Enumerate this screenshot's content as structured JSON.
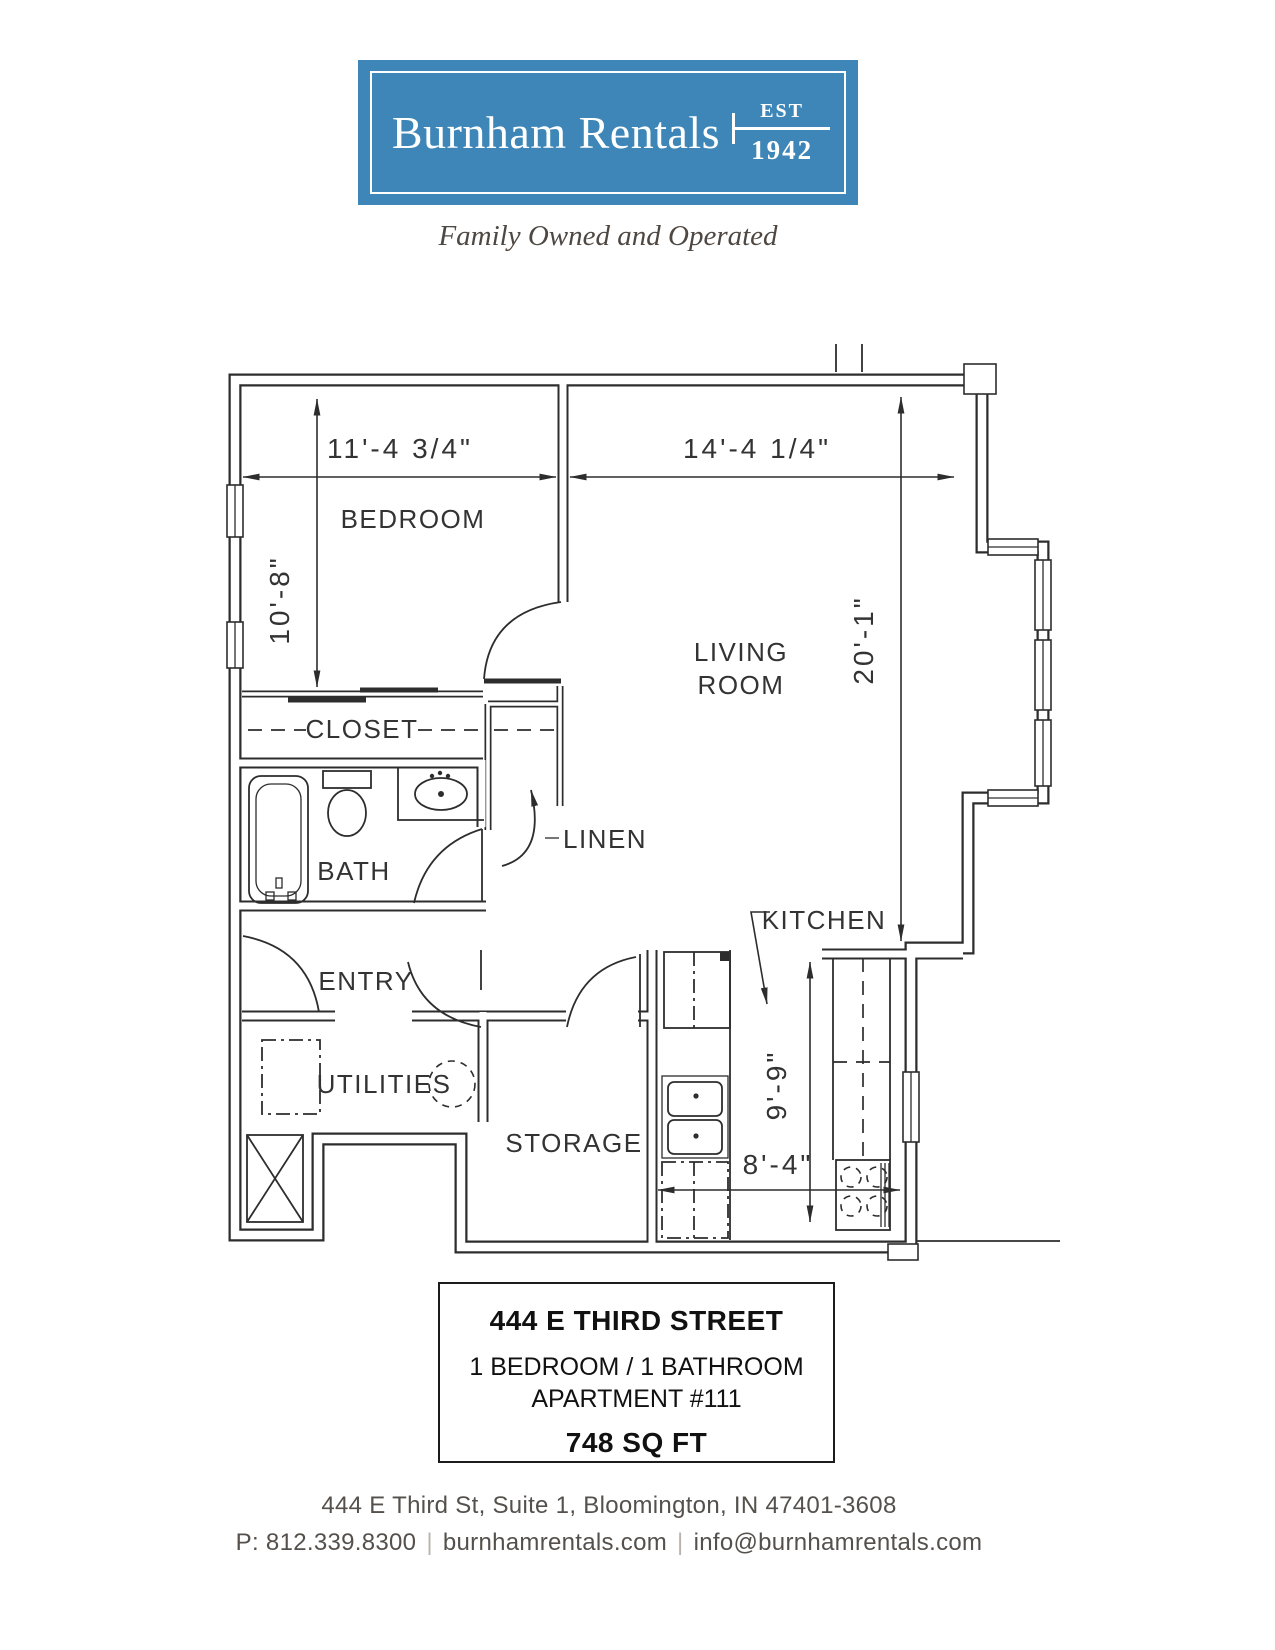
{
  "colors": {
    "accent_blue": "#3d86b7",
    "tagline_brown": "#4e4742",
    "footer_gray": "#55504c",
    "plan_line": "#2d2d2d"
  },
  "logo": {
    "brand": "Burnham Rentals",
    "est": "EST",
    "year": "1942"
  },
  "tagline": "Family Owned and Operated",
  "plan": {
    "rooms": {
      "bedroom": "BEDROOM",
      "closet": "CLOSET",
      "bath": "BATH",
      "linen": "LINEN",
      "entry": "ENTRY",
      "utilities": "UTILITIES",
      "storage": "STORAGE",
      "kitchen": "KITCHEN",
      "living1": "LIVING",
      "living2": "ROOM"
    },
    "dims": {
      "bedroom_w": "11'-4 3/4\"",
      "living_w": "14'-4 1/4\"",
      "bedroom_d": "10'-8\"",
      "living_d": "20'-1\"",
      "kitchen_d": "9'-9\"",
      "kitchen_w": "8'-4\""
    }
  },
  "info": {
    "street": "444 E THIRD STREET",
    "beds": "1 BEDROOM / 1 BATHROOM",
    "apt": "APARTMENT #111",
    "sqft": "748 SQ FT"
  },
  "footer": {
    "address": "444 E Third St, Suite 1, Bloomington, IN  47401-3608",
    "phone": "P: 812.339.8300",
    "sep": "|",
    "site": "burnhamrentals.com",
    "email": "info@burnhamrentals.com"
  }
}
